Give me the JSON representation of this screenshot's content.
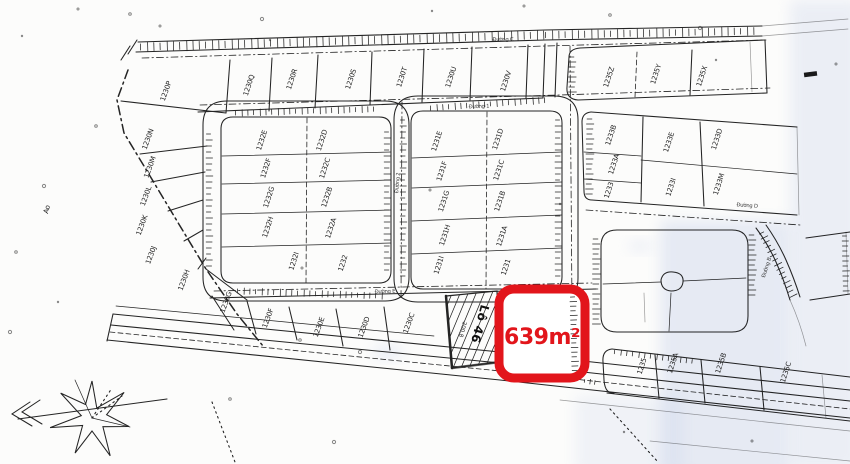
{
  "page": {
    "background": "#fcfcfb",
    "ink_color": "#242424",
    "scan_tint_color": "#c7d2ec"
  },
  "highlight": {
    "label": "639m²",
    "color": "#e2151b"
  },
  "featured_plot": {
    "name": "Lô 46",
    "area_value": "200.8"
  },
  "annotations": {
    "pond": "Ao"
  },
  "road_labels": [
    {
      "text": "Đường C",
      "x": 503,
      "y": 41,
      "rot": -1
    },
    {
      "text": "Đường 1",
      "x": 479,
      "y": 108,
      "rot": -2
    },
    {
      "text": "Đường 2",
      "x": 399,
      "y": 183,
      "rot": -85
    },
    {
      "text": "Đường D",
      "x": 747,
      "y": 207,
      "rot": 4
    },
    {
      "text": "Đường E",
      "x": 385,
      "y": 293,
      "rot": -2
    },
    {
      "text": "Đường B",
      "x": 768,
      "y": 268,
      "rot": -72
    }
  ],
  "plot_labels": [
    {
      "text": "1230P",
      "x": 168,
      "y": 92,
      "rot": -70
    },
    {
      "text": "1230Q",
      "x": 251,
      "y": 86,
      "rot": -72
    },
    {
      "text": "1230R",
      "x": 294,
      "y": 80,
      "rot": -72
    },
    {
      "text": "1230S",
      "x": 353,
      "y": 80,
      "rot": -72
    },
    {
      "text": "1230T",
      "x": 404,
      "y": 78,
      "rot": -72
    },
    {
      "text": "1230U",
      "x": 453,
      "y": 78,
      "rot": -72
    },
    {
      "text": "1230V",
      "x": 508,
      "y": 82,
      "rot": -72
    },
    {
      "text": "1230N",
      "x": 150,
      "y": 140,
      "rot": -70
    },
    {
      "text": "1230M",
      "x": 152,
      "y": 168,
      "rot": -70
    },
    {
      "text": "1230L",
      "x": 148,
      "y": 197,
      "rot": -70
    },
    {
      "text": "1230K",
      "x": 144,
      "y": 226,
      "rot": -70
    },
    {
      "text": "1230J",
      "x": 153,
      "y": 256,
      "rot": -70
    },
    {
      "text": "1230H",
      "x": 186,
      "y": 281,
      "rot": -70
    },
    {
      "text": "1230G",
      "x": 228,
      "y": 303,
      "rot": -70
    },
    {
      "text": "1230F",
      "x": 270,
      "y": 319,
      "rot": -70
    },
    {
      "text": "1230E",
      "x": 321,
      "y": 328,
      "rot": -70
    },
    {
      "text": "1230D",
      "x": 366,
      "y": 328,
      "rot": -70
    },
    {
      "text": "1230C",
      "x": 411,
      "y": 324,
      "rot": -70
    },
    {
      "text": "1232E",
      "x": 264,
      "y": 141,
      "rot": -72
    },
    {
      "text": "1232D",
      "x": 324,
      "y": 141,
      "rot": -72
    },
    {
      "text": "1232F",
      "x": 268,
      "y": 169,
      "rot": -72
    },
    {
      "text": "1232C",
      "x": 327,
      "y": 169,
      "rot": -72
    },
    {
      "text": "1232G",
      "x": 271,
      "y": 198,
      "rot": -72
    },
    {
      "text": "1232B",
      "x": 329,
      "y": 198,
      "rot": -72
    },
    {
      "text": "1232H",
      "x": 270,
      "y": 228,
      "rot": -72
    },
    {
      "text": "1232A",
      "x": 333,
      "y": 229,
      "rot": -72
    },
    {
      "text": "1232I",
      "x": 296,
      "y": 262,
      "rot": -72
    },
    {
      "text": "1232",
      "x": 345,
      "y": 264,
      "rot": -72
    },
    {
      "text": "1231E",
      "x": 439,
      "y": 142,
      "rot": -72
    },
    {
      "text": "1231D",
      "x": 500,
      "y": 140,
      "rot": -72
    },
    {
      "text": "1231F",
      "x": 444,
      "y": 172,
      "rot": -72
    },
    {
      "text": "1231C",
      "x": 501,
      "y": 171,
      "rot": -72
    },
    {
      "text": "1231G",
      "x": 446,
      "y": 202,
      "rot": -72
    },
    {
      "text": "1231B",
      "x": 502,
      "y": 202,
      "rot": -72
    },
    {
      "text": "1231H",
      "x": 447,
      "y": 236,
      "rot": -72
    },
    {
      "text": "1231A",
      "x": 504,
      "y": 237,
      "rot": -72
    },
    {
      "text": "1231I",
      "x": 441,
      "y": 266,
      "rot": -72
    },
    {
      "text": "1231",
      "x": 508,
      "y": 268,
      "rot": -72
    },
    {
      "text": "1235Z",
      "x": 611,
      "y": 78,
      "rot": -72
    },
    {
      "text": "1235Y",
      "x": 658,
      "y": 75,
      "rot": -72
    },
    {
      "text": "1235X",
      "x": 704,
      "y": 77,
      "rot": -72
    },
    {
      "text": "1233B",
      "x": 613,
      "y": 136,
      "rot": -72
    },
    {
      "text": "1233A",
      "x": 616,
      "y": 165,
      "rot": -72
    },
    {
      "text": "1233",
      "x": 611,
      "y": 191,
      "rot": -72
    },
    {
      "text": "1233E",
      "x": 671,
      "y": 143,
      "rot": -72
    },
    {
      "text": "1233I",
      "x": 673,
      "y": 188,
      "rot": -72
    },
    {
      "text": "1233D",
      "x": 719,
      "y": 140,
      "rot": -72
    },
    {
      "text": "1233M",
      "x": 721,
      "y": 185,
      "rot": -72
    },
    {
      "text": "1235",
      "x": 644,
      "y": 367,
      "rot": -72
    },
    {
      "text": "1235A",
      "x": 675,
      "y": 364,
      "rot": -72
    },
    {
      "text": "1235B",
      "x": 723,
      "y": 364,
      "rot": -72
    },
    {
      "text": "1235C",
      "x": 788,
      "y": 373,
      "rot": -72
    }
  ]
}
